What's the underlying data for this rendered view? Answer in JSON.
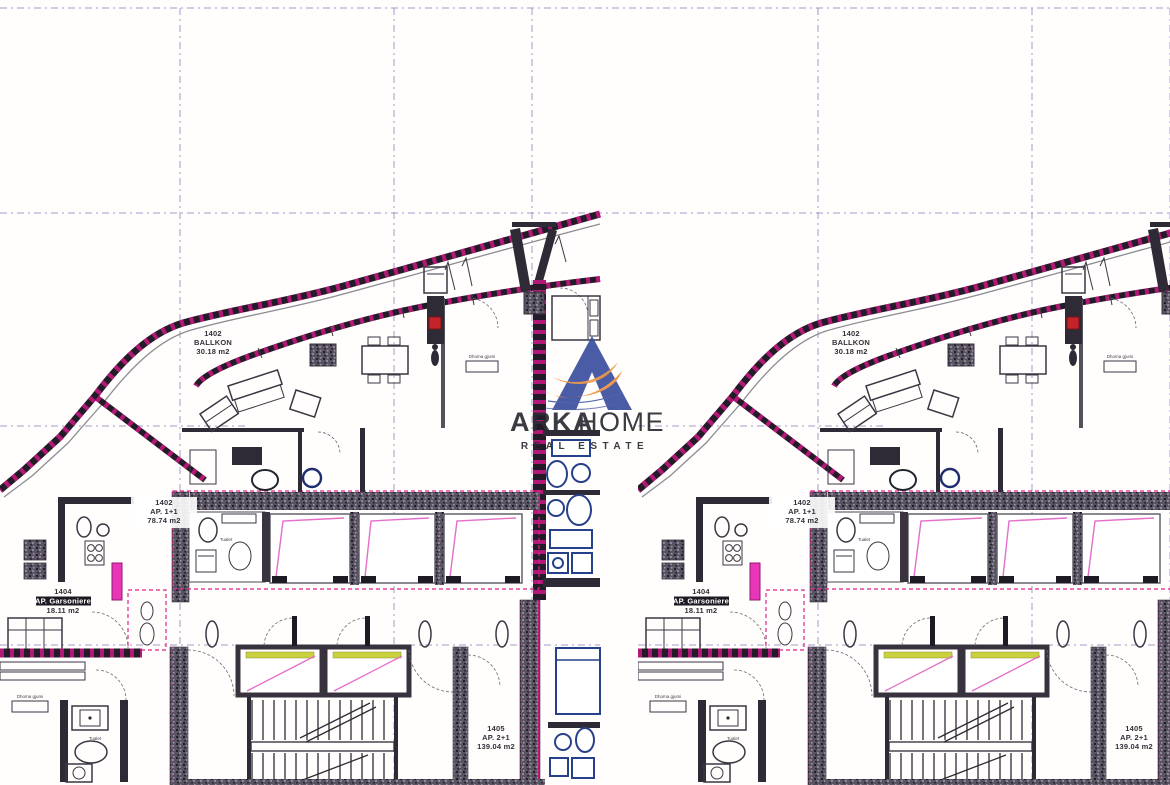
{
  "document": {
    "kind": "architectural floor plan, duplicated twice side by side"
  },
  "watermark": {
    "brand_primary": "ARKA",
    "brand_secondary": "HOME",
    "tagline": "REAL ESTATE",
    "brand_color": "#2c3d91",
    "brand_color_light": "#44579f",
    "accent_color": "#ef9340"
  },
  "plan": {
    "units": [
      {
        "id": "1402",
        "name": "BALLKON",
        "area": "30.18 m2"
      },
      {
        "id": "1402",
        "name": "AP. 1+1",
        "area": "78.74 m2"
      },
      {
        "id": "1404",
        "name": "AP. Garsoniere",
        "area": "18.11 m2"
      },
      {
        "id": "1405",
        "name": "AP. 2+1",
        "area": "139.04 m2"
      }
    ],
    "rooms": [
      {
        "label": "Dhoma gjumi"
      },
      {
        "label": "Dhoma gjumi"
      },
      {
        "label": "Tualet"
      },
      {
        "label": "Tualet"
      }
    ],
    "colors": {
      "boundary_magenta": "#d6188a",
      "grid_purple": "#9b8ec4",
      "fixture_blue": "#27408b",
      "elevator_highlight": "#c9d13f",
      "wall_dark": "#38323e",
      "accent_red": "#c4232a"
    }
  }
}
